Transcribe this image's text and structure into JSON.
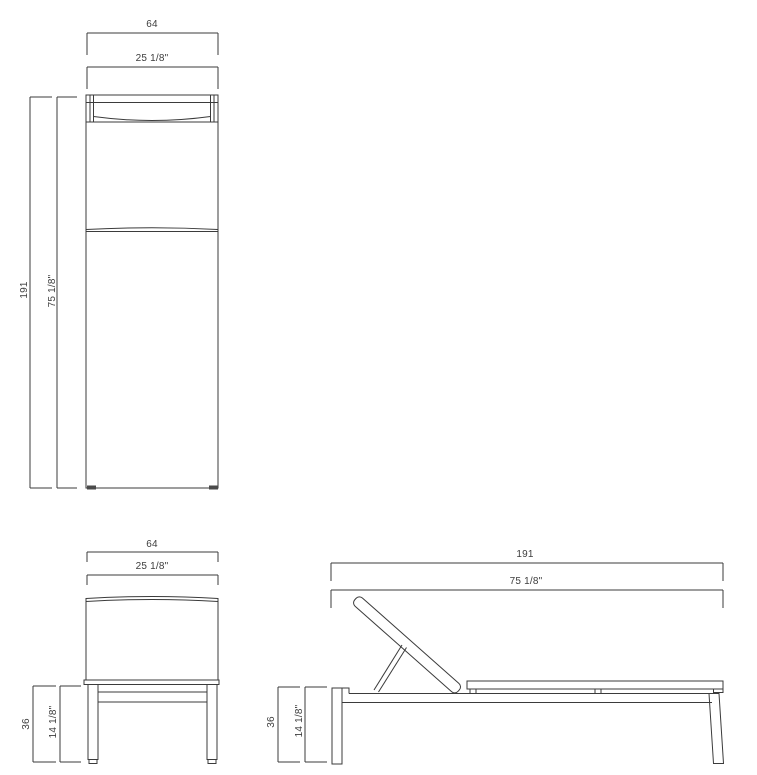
{
  "title": "Chaise lounge technical dimension drawing (three orthographic views)",
  "units": {
    "primary": "cm",
    "secondary": "inches"
  },
  "colors": {
    "line": "#3b3b3b",
    "text": "#3d3d3d",
    "background": "#ffffff"
  },
  "views": {
    "plan": {
      "label": "plan (top) view",
      "width_cm": "64",
      "width_in": "25 1/8\"",
      "length_cm": "191",
      "length_in": "75 1/8\""
    },
    "front": {
      "label": "front view",
      "width_cm": "64",
      "width_in": "25 1/8\"",
      "height_cm": "36",
      "height_in": "14 1/8\""
    },
    "side": {
      "label": "side view",
      "length_cm": "191",
      "length_in": "75 1/8\"",
      "height_cm": "36",
      "height_in": "14 1/8\""
    }
  }
}
